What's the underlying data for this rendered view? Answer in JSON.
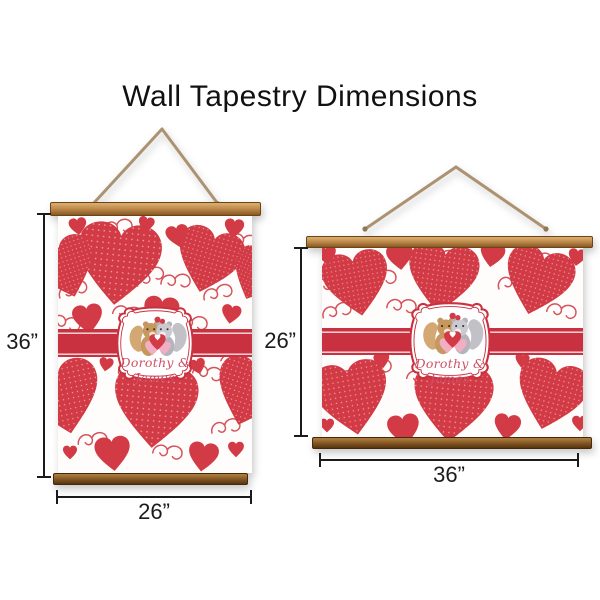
{
  "title": "Wall Tapestry Dimensions",
  "portrait_tapestry": {
    "orientation": "portrait",
    "height_label": "36”",
    "width_label": "26”",
    "plate_text": "Dorothy & James"
  },
  "landscape_tapestry": {
    "orientation": "landscape",
    "height_label": "26”",
    "width_label": "36”",
    "plate_text": "Dorothy & James"
  },
  "colors": {
    "heart-red": "#d23a45",
    "band-red": "#c93140",
    "swirl-red": "#d4545c",
    "dot-pink": "#eda9ad",
    "wood-light": "#b78446",
    "wood-light-hi": "#d9ab6a",
    "wood-dark": "#7d5020",
    "wood-dark-hi": "#a97a3c",
    "rope-tan": "#ab9371",
    "script-red": "#cf5066",
    "plate-white": "#ffffff",
    "dim-black": "#1b1b1b",
    "title-black": "#111111",
    "squirrel-tan": "#c6985f",
    "squirrel-gray": "#b5b4ba",
    "heart-pink": "#f2aec3"
  }
}
